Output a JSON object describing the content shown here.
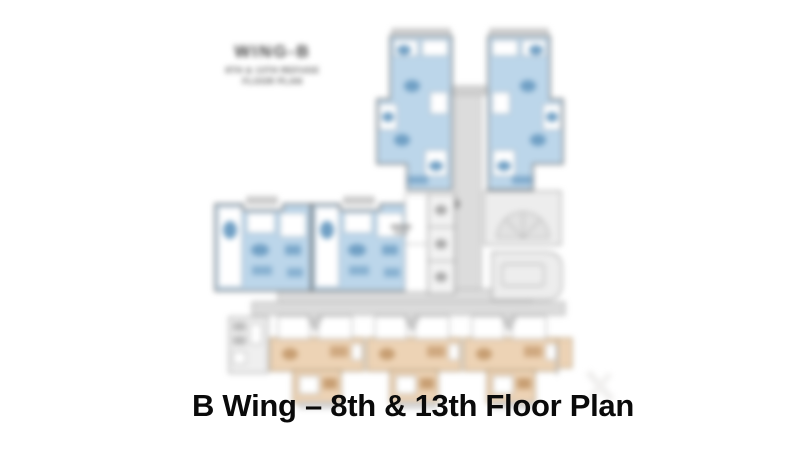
{
  "page": {
    "background": "#ffffff"
  },
  "plan": {
    "header": {
      "wing_label": "WING-B",
      "subtitle_line1": "8TH & 13TH REFUGE",
      "subtitle_line2": "FLOOR PLAN"
    },
    "colors": {
      "unit_blue": "#bcd6ea",
      "unit_blue_dark": "#6f9fc4",
      "unit_tan": "#edd3b5",
      "unit_tan_dark": "#c79e72",
      "corridor_gray": "#dcdcdc",
      "room_gray": "#ededed",
      "wall": "#5a5a5a"
    }
  },
  "caption": {
    "title": "B Wing – 8th & 13th Floor Plan",
    "color": "#0a0a0a"
  }
}
